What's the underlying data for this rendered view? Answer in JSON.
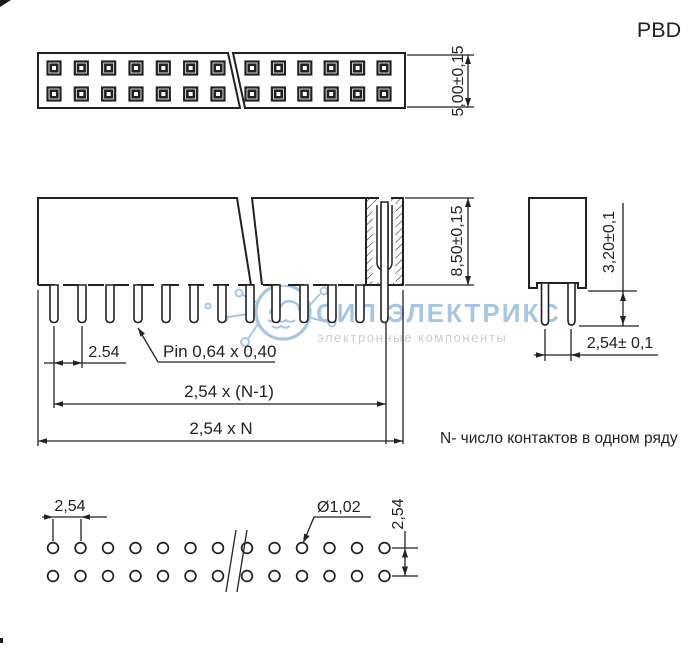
{
  "title": "PBD",
  "note": "N- число контактов в одном ряду",
  "watermark": {
    "brand": "СИЛ ЭЛЕКТРИКС",
    "tagline": "электронные компоненты"
  },
  "views": {
    "top": {
      "rows": 2,
      "holes_left": 7,
      "holes_right": 6,
      "dim_height": "5,00±0,15"
    },
    "side": {
      "pins_left": 8,
      "pins_right": 4,
      "dim_height": "8,50±0,15",
      "dim_pitch": "2.54",
      "dim_pin": "Pin 0,64 x 0,40",
      "dim_span": "2,54 x (N-1)",
      "dim_total": "2,54 x N"
    },
    "end": {
      "dim_pin_length": "3,20±0,1",
      "dim_row_pitch": "2,54± 0,1"
    },
    "footprint": {
      "rows": 2,
      "holes_left": 7,
      "holes_right": 6,
      "dim_pitch": "2,54",
      "dim_hole": "Ø1,02",
      "dim_row_pitch": "2,54"
    }
  },
  "colors": {
    "line": "#222222",
    "watermark_blue": "#a6c6e6",
    "watermark_gray": "#c9ced6",
    "background": "#ffffff"
  }
}
